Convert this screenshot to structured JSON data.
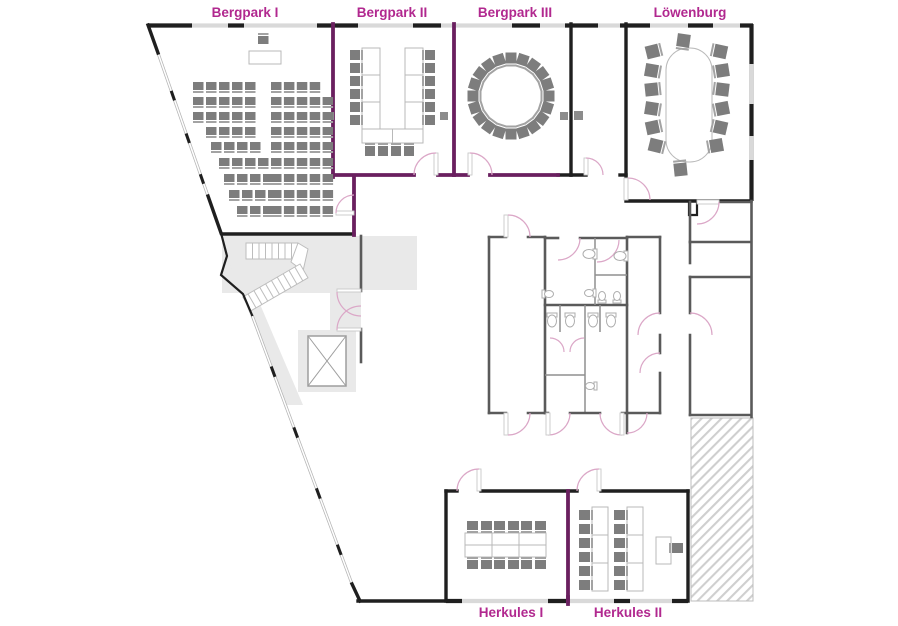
{
  "labels": {
    "bergpark1": "Bergpark I",
    "bergpark2": "Bergpark II",
    "bergpark3": "Bergpark III",
    "loewenburg": "Löwenburg",
    "herkules1": "Herkules I",
    "herkules2": "Herkules II"
  },
  "colors": {
    "label": "#b1288f",
    "wall_black": "#1f1f1f",
    "wall_purple": "#6a1f5f",
    "wall_gray": "#5a5a5a",
    "window_gray": "#d9d9d9",
    "floor_gray": "#e9e9e9",
    "door_arc": "#dba7c7",
    "chair": "#7d7d7d",
    "chair_bar": "#a3a3a3",
    "table_stroke": "#b9b9b9",
    "hatch": "#cfcfcf"
  },
  "furniture": {
    "rooms": [
      {
        "name": "bergpark1-theatre-seating",
        "chair": {
          "w": 10.5,
          "h": 8,
          "bar": "bottom"
        },
        "rows": [
          {
            "y": 82,
            "groups": [
              {
                "x": 193,
                "n": 5,
                "dx": 13
              },
              {
                "x": 271,
                "n": 4,
                "dx": 12.9
              }
            ]
          },
          {
            "y": 97,
            "groups": [
              {
                "x": 193,
                "n": 5,
                "dx": 13
              },
              {
                "x": 271,
                "n": 5,
                "dx": 12.9
              }
            ]
          },
          {
            "y": 112,
            "groups": [
              {
                "x": 193,
                "n": 5,
                "dx": 13
              },
              {
                "x": 271,
                "n": 5,
                "dx": 12.9
              }
            ]
          },
          {
            "y": 127,
            "groups": [
              {
                "x": 206,
                "n": 4,
                "dx": 13
              },
              {
                "x": 271,
                "n": 5,
                "dx": 12.9
              }
            ]
          },
          {
            "y": 142,
            "groups": [
              {
                "x": 211,
                "n": 4,
                "dx": 13
              },
              {
                "x": 271,
                "n": 5,
                "dx": 12.9
              }
            ]
          },
          {
            "y": 158,
            "groups": [
              {
                "x": 219,
                "n": 4,
                "dx": 13
              },
              {
                "x": 271,
                "n": 5,
                "dx": 12.9
              }
            ]
          },
          {
            "y": 174,
            "groups": [
              {
                "x": 224,
                "n": 4,
                "dx": 13
              },
              {
                "x": 271,
                "n": 5,
                "dx": 12.9
              }
            ]
          },
          {
            "y": 190,
            "groups": [
              {
                "x": 229,
                "n": 4,
                "dx": 13
              },
              {
                "x": 271,
                "n": 5,
                "dx": 12.9
              }
            ]
          },
          {
            "y": 206,
            "groups": [
              {
                "x": 237,
                "n": 3,
                "dx": 13
              },
              {
                "x": 271,
                "n": 5,
                "dx": 12.9
              }
            ]
          }
        ],
        "chairs": [
          [
            258,
            36,
            0,
            "top"
          ]
        ],
        "tables": [
          [
            249,
            51,
            32,
            13
          ]
        ]
      },
      {
        "name": "bergpark2-ushape",
        "chair": {
          "w": 10,
          "h": 10
        },
        "tables": [
          [
            362,
            48,
            18,
            27
          ],
          [
            362,
            75,
            18,
            27
          ],
          [
            362,
            102,
            18,
            27
          ],
          [
            405,
            48,
            18,
            27
          ],
          [
            405,
            75,
            18,
            27
          ],
          [
            405,
            102,
            18,
            27
          ],
          [
            362,
            129,
            30.5,
            14
          ],
          [
            392.5,
            129,
            30.5,
            14
          ]
        ],
        "chairs": [
          [
            350,
            50,
            0,
            "right"
          ],
          [
            350,
            63,
            0,
            "right"
          ],
          [
            350,
            76,
            0,
            "right"
          ],
          [
            350,
            89,
            0,
            "right"
          ],
          [
            350,
            102,
            0,
            "right"
          ],
          [
            350,
            115,
            0,
            "right"
          ],
          [
            425,
            50,
            0,
            "left"
          ],
          [
            425,
            63,
            0,
            "left"
          ],
          [
            425,
            76,
            0,
            "left"
          ],
          [
            425,
            89,
            0,
            "left"
          ],
          [
            425,
            102,
            0,
            "left"
          ],
          [
            425,
            115,
            0,
            "left"
          ],
          [
            365,
            146,
            0,
            "top"
          ],
          [
            378,
            146,
            0,
            "top"
          ],
          [
            391,
            146,
            0,
            "top"
          ],
          [
            404,
            146,
            0,
            "top"
          ]
        ]
      },
      {
        "name": "bergpark3-chair-circle",
        "chair": {
          "w": 11,
          "h": 11,
          "bar": "bottom"
        },
        "circle": {
          "cx": 511,
          "cy": 96,
          "r": 38,
          "n": 20
        }
      },
      {
        "name": "loewenburg-boardroom",
        "chair": {
          "w": 13,
          "h": 13
        },
        "tables": [
          [
            666,
            48,
            46,
            114,
            22
          ]
        ],
        "chairs": [
          [
            677,
            34,
            8,
            "bottom"
          ],
          [
            646,
            45,
            -14,
            "right"
          ],
          [
            645,
            64,
            10,
            "right"
          ],
          [
            645,
            83,
            -6,
            "right"
          ],
          [
            645,
            102,
            9,
            "right"
          ],
          [
            646,
            121,
            -12,
            "right"
          ],
          [
            649,
            139,
            14,
            "right"
          ],
          [
            714,
            45,
            12,
            "left"
          ],
          [
            716,
            64,
            -9,
            "left"
          ],
          [
            716,
            83,
            7,
            "left"
          ],
          [
            716,
            102,
            -11,
            "left"
          ],
          [
            714,
            121,
            13,
            "left"
          ],
          [
            710,
            139,
            -10,
            "left"
          ],
          [
            674,
            163,
            -6,
            "top"
          ]
        ]
      },
      {
        "name": "herkules1-block",
        "chair": {
          "w": 11,
          "h": 9
        },
        "tables": [
          [
            465,
            533,
            27,
            12
          ],
          [
            492,
            533,
            27,
            12
          ],
          [
            519,
            533,
            27,
            12
          ],
          [
            465,
            545,
            27,
            12
          ],
          [
            492,
            545,
            27,
            12
          ],
          [
            519,
            545,
            27,
            12
          ]
        ],
        "chairs": [
          [
            467,
            521,
            0,
            "bottom"
          ],
          [
            481,
            521,
            0,
            "bottom"
          ],
          [
            494,
            521,
            0,
            "bottom"
          ],
          [
            508,
            521,
            0,
            "bottom"
          ],
          [
            521,
            521,
            0,
            "bottom"
          ],
          [
            535,
            521,
            0,
            "bottom"
          ],
          [
            467,
            560,
            0,
            "top"
          ],
          [
            481,
            560,
            0,
            "top"
          ],
          [
            494,
            560,
            0,
            "top"
          ],
          [
            508,
            560,
            0,
            "top"
          ],
          [
            521,
            560,
            0,
            "top"
          ],
          [
            535,
            560,
            0,
            "top"
          ]
        ]
      },
      {
        "name": "herkules2-classroom",
        "chair": {
          "w": 11,
          "h": 10
        },
        "tables": [
          [
            592,
            507,
            16,
            28
          ],
          [
            592,
            535,
            16,
            28
          ],
          [
            592,
            563,
            16,
            28
          ],
          [
            627,
            507,
            16,
            28
          ],
          [
            627,
            535,
            16,
            28
          ],
          [
            627,
            563,
            16,
            28
          ],
          [
            656,
            537,
            15,
            27
          ]
        ],
        "chairs": [
          [
            579,
            510,
            0,
            "right"
          ],
          [
            579,
            524,
            0,
            "right"
          ],
          [
            579,
            538,
            0,
            "right"
          ],
          [
            579,
            552,
            0,
            "right"
          ],
          [
            579,
            566,
            0,
            "right"
          ],
          [
            579,
            580,
            0,
            "right"
          ],
          [
            614,
            510,
            0,
            "right"
          ],
          [
            614,
            524,
            0,
            "right"
          ],
          [
            614,
            538,
            0,
            "right"
          ],
          [
            614,
            552,
            0,
            "right"
          ],
          [
            614,
            566,
            0,
            "right"
          ],
          [
            614,
            580,
            0,
            "right"
          ],
          [
            672,
            543,
            0,
            "left"
          ]
        ]
      }
    ]
  }
}
